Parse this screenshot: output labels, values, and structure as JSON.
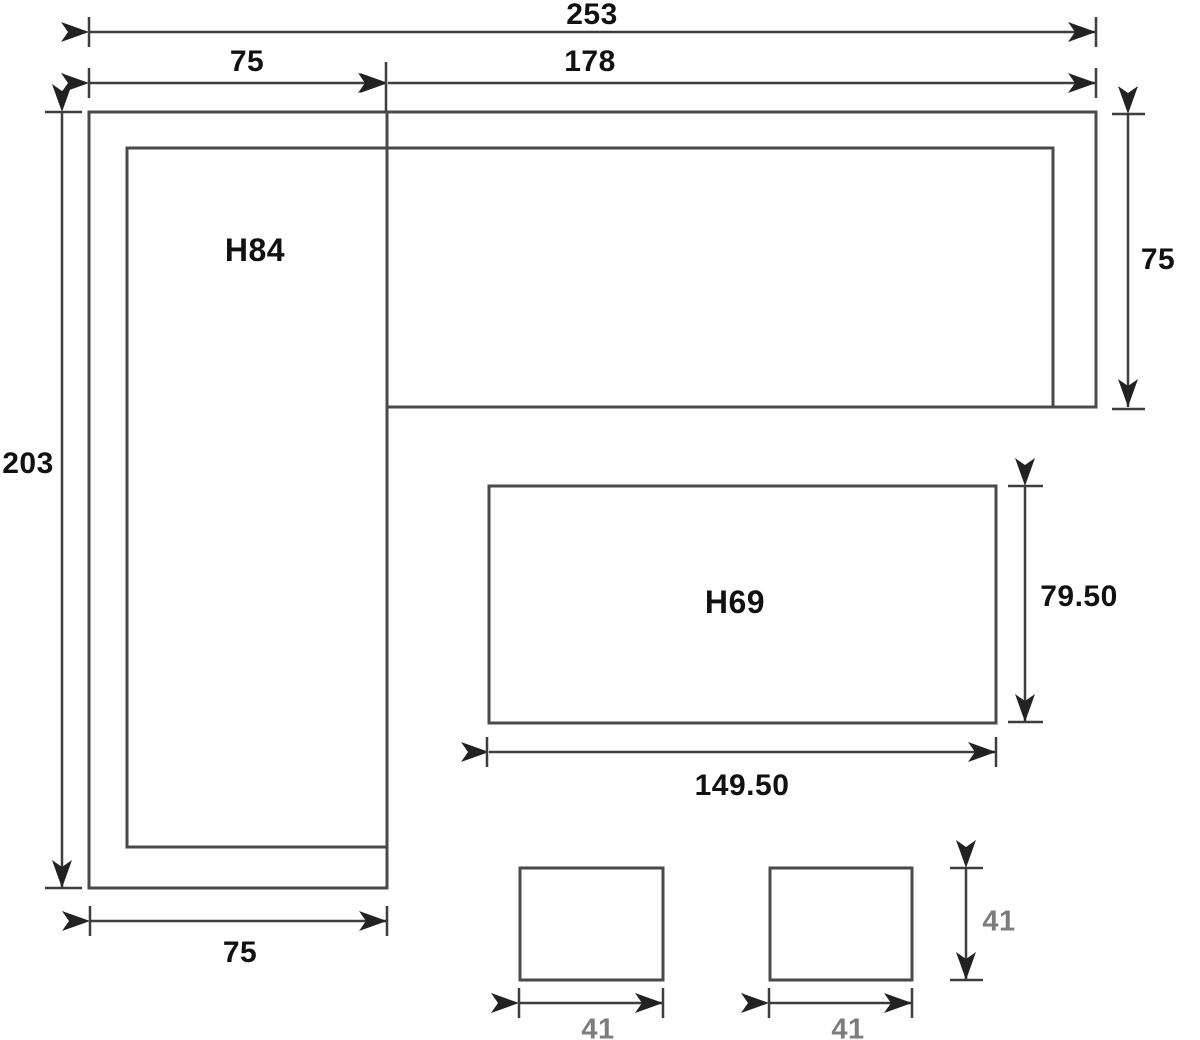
{
  "diagram": {
    "labels": {
      "total_width": "253",
      "left_width": "75",
      "right_width": "178",
      "total_depth": "203",
      "right_depth": "75",
      "left_height": "H84",
      "table_height": "H69",
      "table_depth": "79.50",
      "table_width": "149.50",
      "left_bottom_width": "75",
      "stool1_width": "41",
      "stool2_width": "41",
      "stool_depth": "41"
    },
    "colors": {
      "outline": "#4a4a4a",
      "dimension_line": "#3d3d3d",
      "arrow": "#222222",
      "label_text": "#111111",
      "muted_label_text": "#7d7d7d",
      "background": "#ffffff"
    }
  }
}
